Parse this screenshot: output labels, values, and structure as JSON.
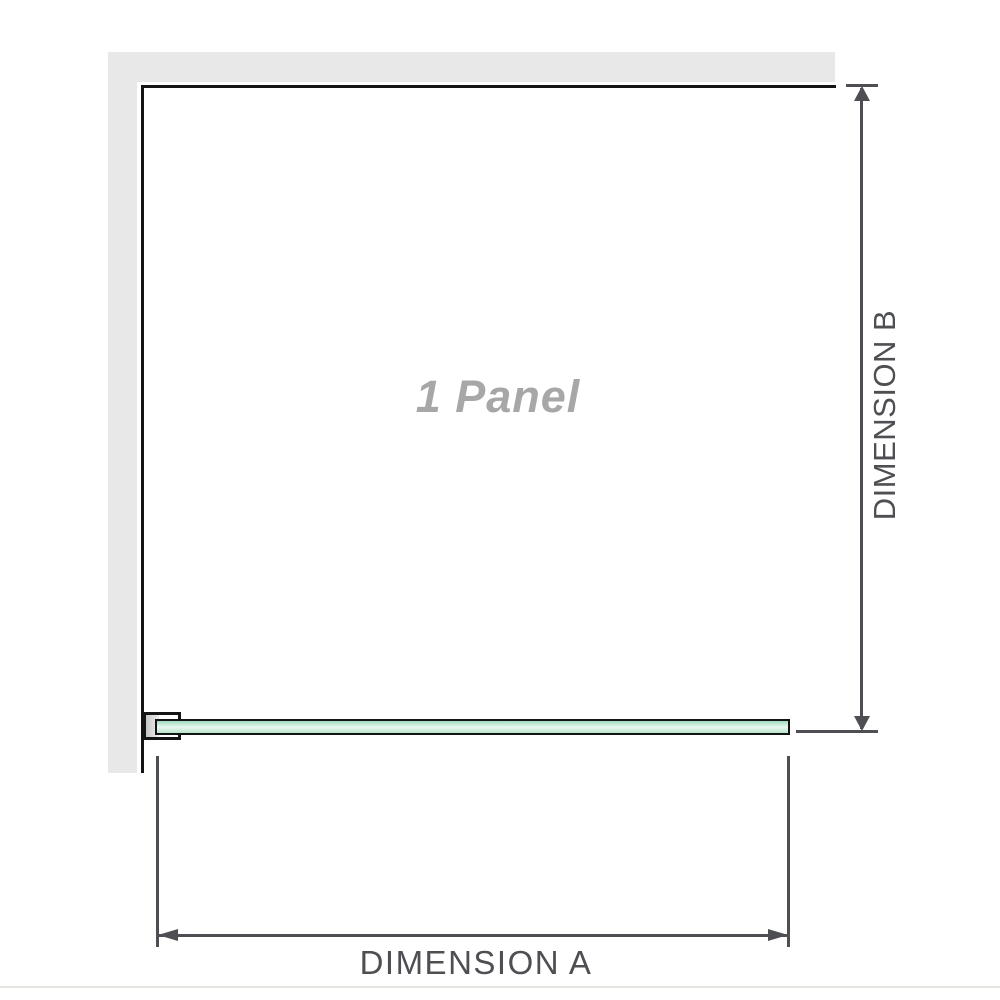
{
  "diagram": {
    "panel_label": "1 Panel",
    "dimension_a_label": "DIMENSION A",
    "dimension_b_label": "DIMENSION B"
  },
  "colors": {
    "wall_gray": "#e8e8e8",
    "outline_black": "#141414",
    "dimension_gray": "#4d4f52",
    "label_gray": "#a7a7a7",
    "glass_green_top": "#9edcbe",
    "glass_green_mid": "#e9f7f0",
    "glass_green_bottom": "#b6e5cd",
    "baseline_light": "#e7e4df"
  }
}
